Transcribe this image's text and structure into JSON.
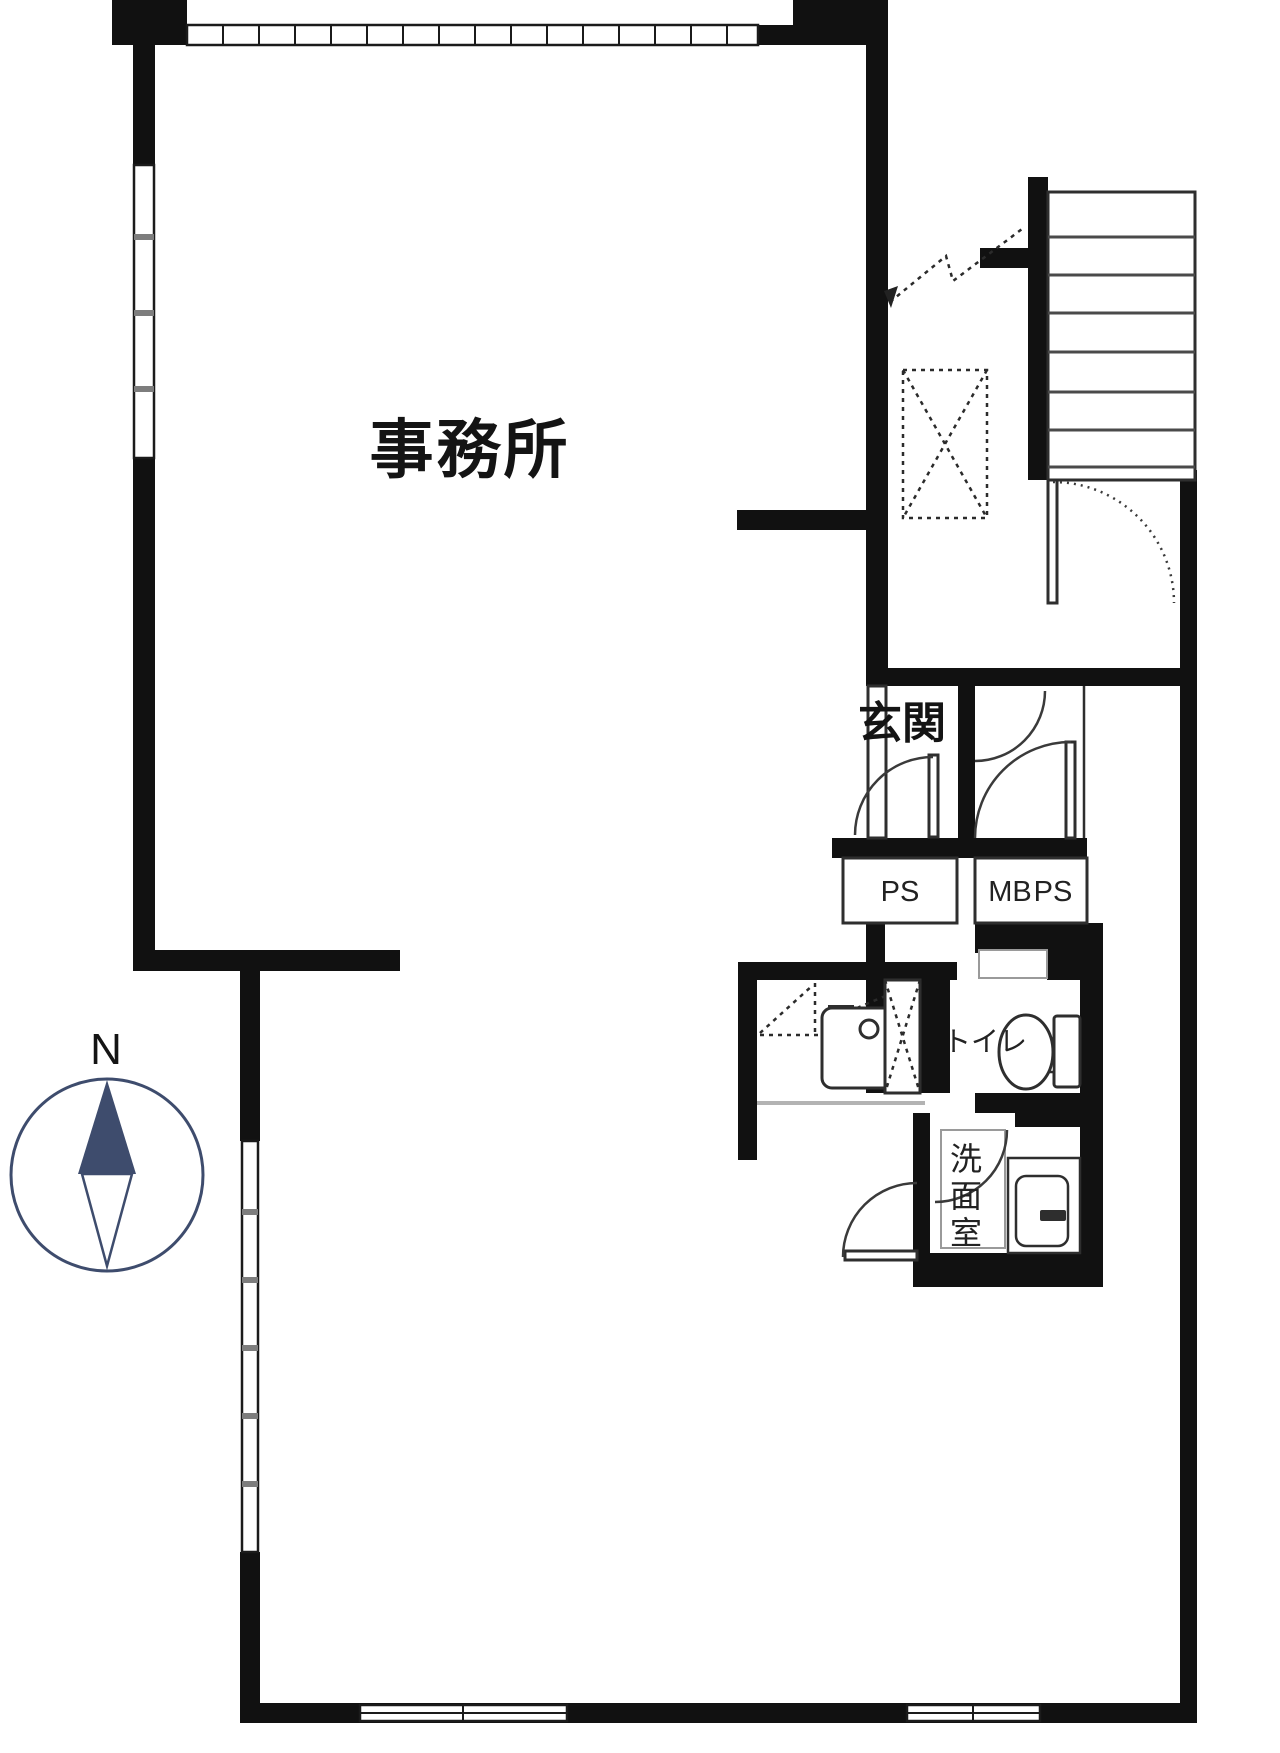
{
  "colors": {
    "wall": "#111111",
    "line": "#2e2e2e",
    "accent_navy": "#3e4c6d",
    "muted_gray": "#9a9a9a",
    "counter_gray": "#b3b3b3"
  },
  "labels": {
    "office": "事務所",
    "entrance": "玄関",
    "ps": "PS",
    "mb": "MB",
    "mb_ps": "PS",
    "toilet": "トイレ",
    "washroom_chars": [
      "洗",
      "面",
      "室"
    ],
    "compass_north": "N"
  }
}
